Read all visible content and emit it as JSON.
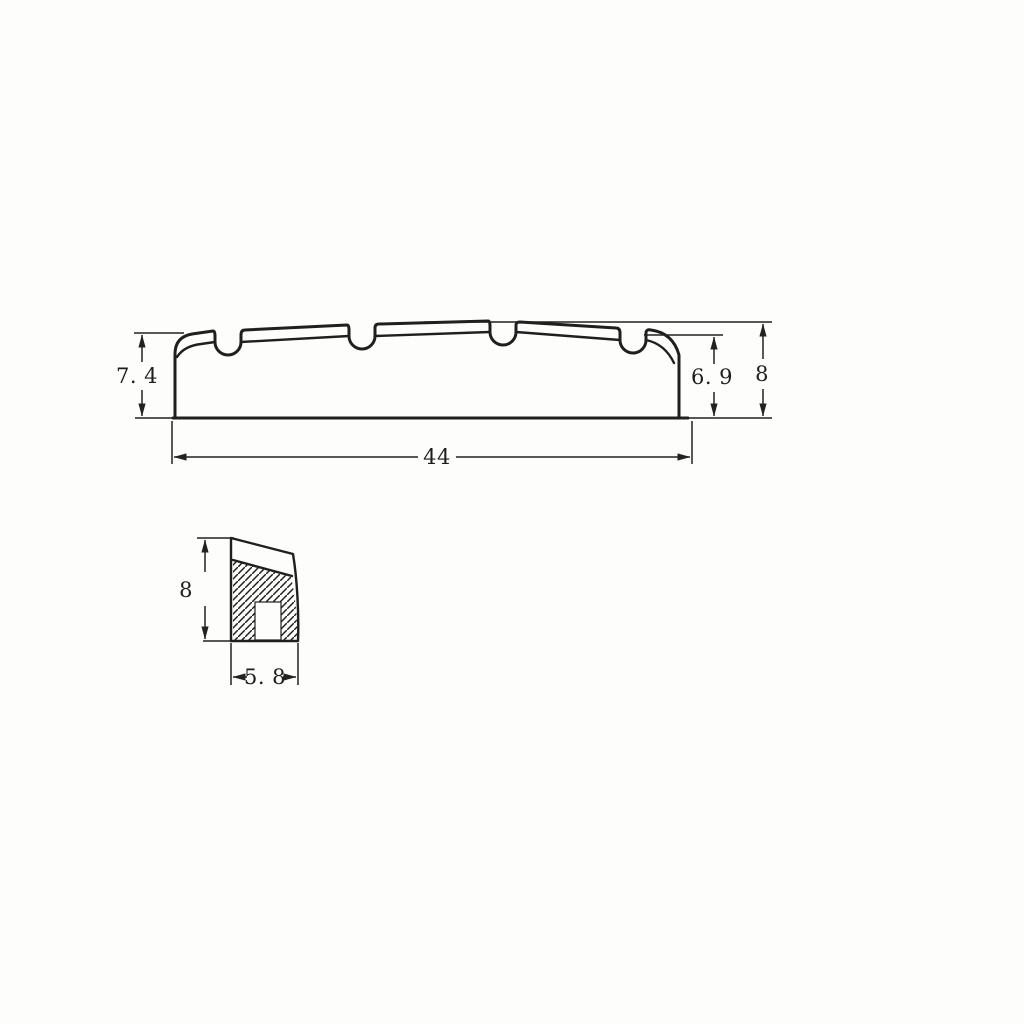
{
  "canvas": {
    "background": "#fdfdfc",
    "ink_color": "#1f1f1f",
    "description": "Scanned technical drawing of a bass guitar nut, two orthographic views with dimensions"
  },
  "front_view": {
    "name": "nut-front-profile",
    "slot_count": 4,
    "dims": {
      "left_height": {
        "label": "7. 4",
        "orientation": "vertical",
        "position": "left"
      },
      "right_height": {
        "label": "6. 9",
        "orientation": "vertical",
        "position": "right-inner"
      },
      "overall_height": {
        "label": "8",
        "orientation": "vertical",
        "position": "right-outer"
      },
      "overall_width": {
        "label": "44",
        "orientation": "horizontal",
        "position": "bottom"
      }
    }
  },
  "section_view": {
    "name": "nut-cross-section",
    "hatched": true,
    "dims": {
      "height": {
        "label": "8",
        "orientation": "vertical",
        "position": "left"
      },
      "base_width": {
        "label": "5. 8",
        "orientation": "horizontal",
        "position": "bottom"
      }
    }
  }
}
